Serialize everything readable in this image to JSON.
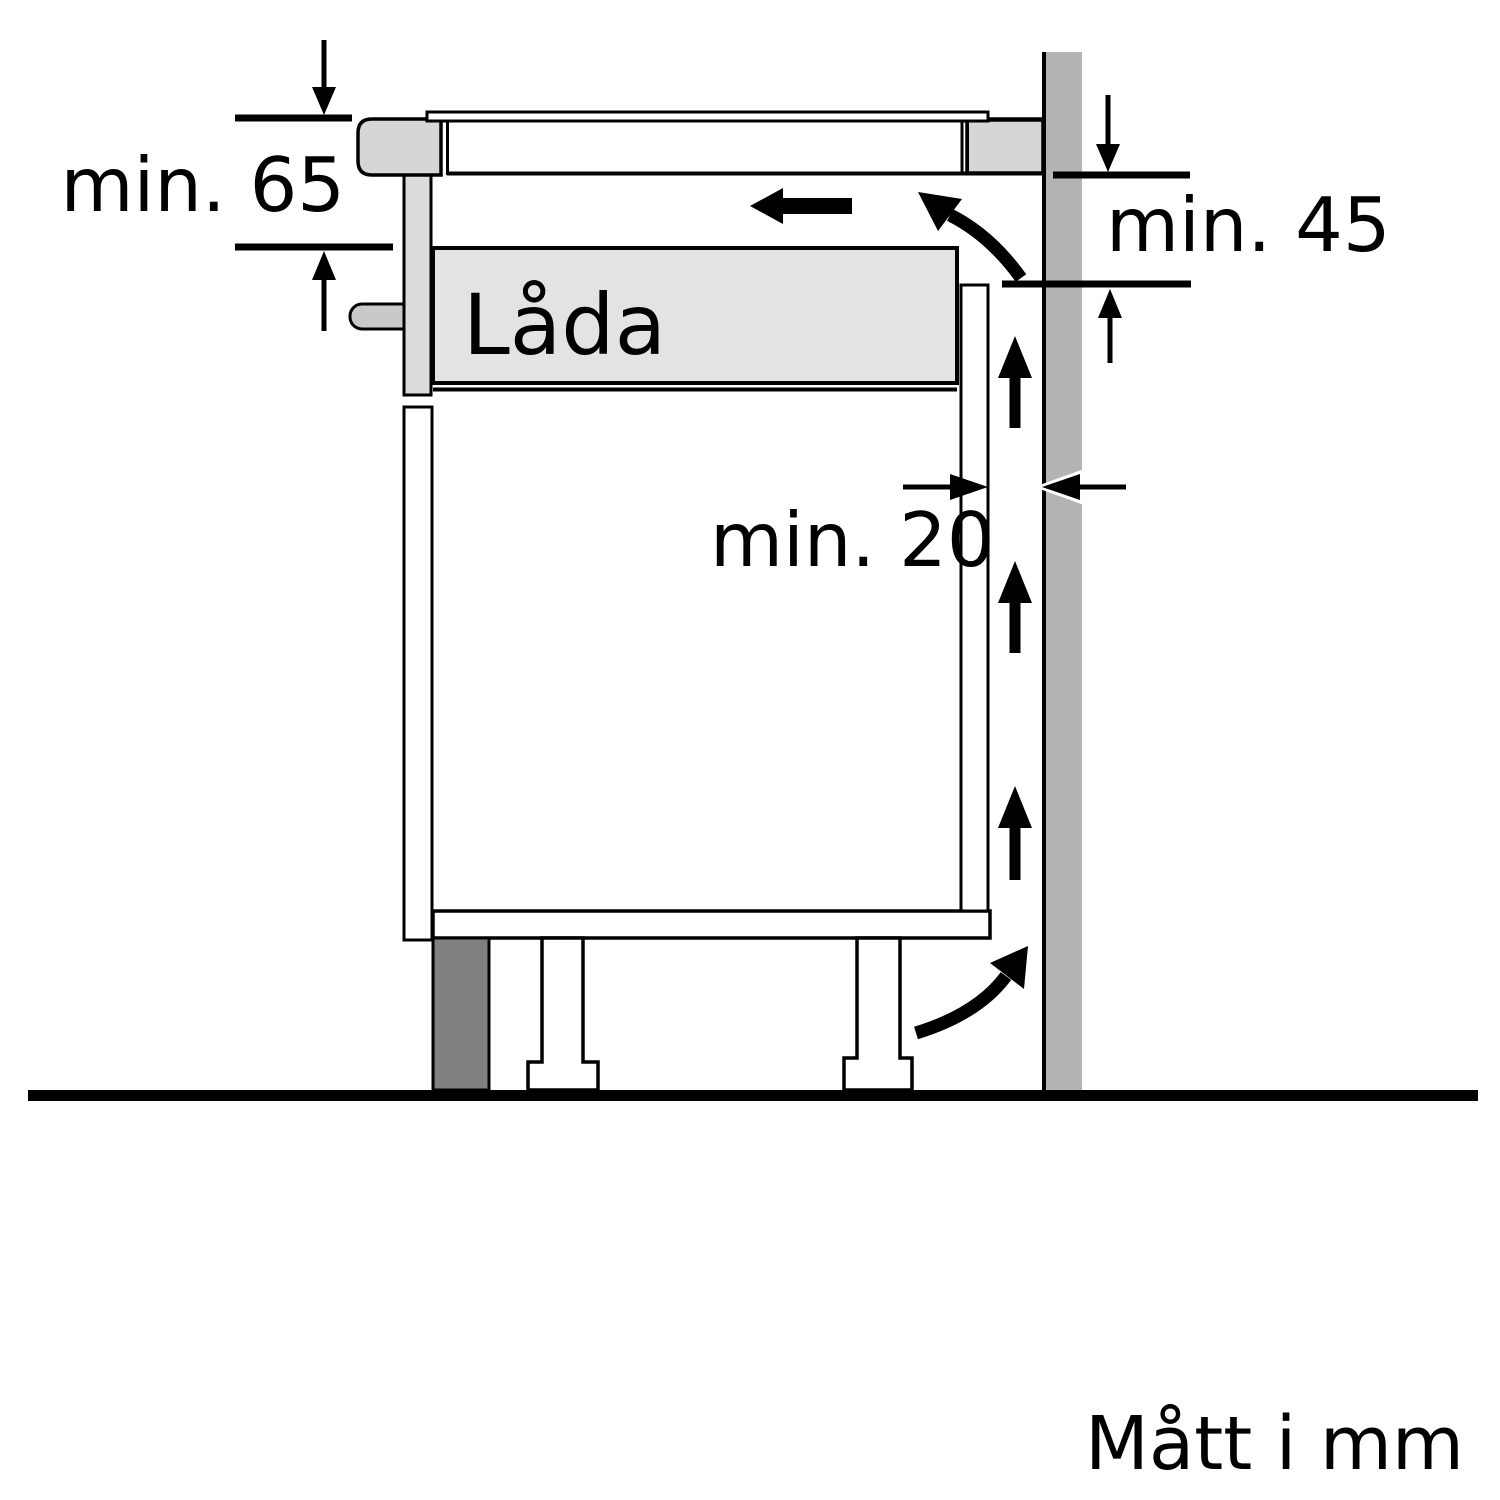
{
  "diagram": {
    "title": "hob-installation-clearance-side-view",
    "labels": {
      "min65": "min. 65",
      "min45": "min. 45",
      "min20": "min. 20",
      "drawer": "Låda",
      "units_note": "Mått i mm"
    },
    "colors": {
      "background": "#ffffff",
      "line": "#000000",
      "wall": "#b3b3b3",
      "worktop": "#d6d6d6",
      "rail": "#dcdcdc",
      "handle": "#c9c9c9",
      "drawer": "#e3e3e3",
      "plinth": "#808080"
    }
  }
}
